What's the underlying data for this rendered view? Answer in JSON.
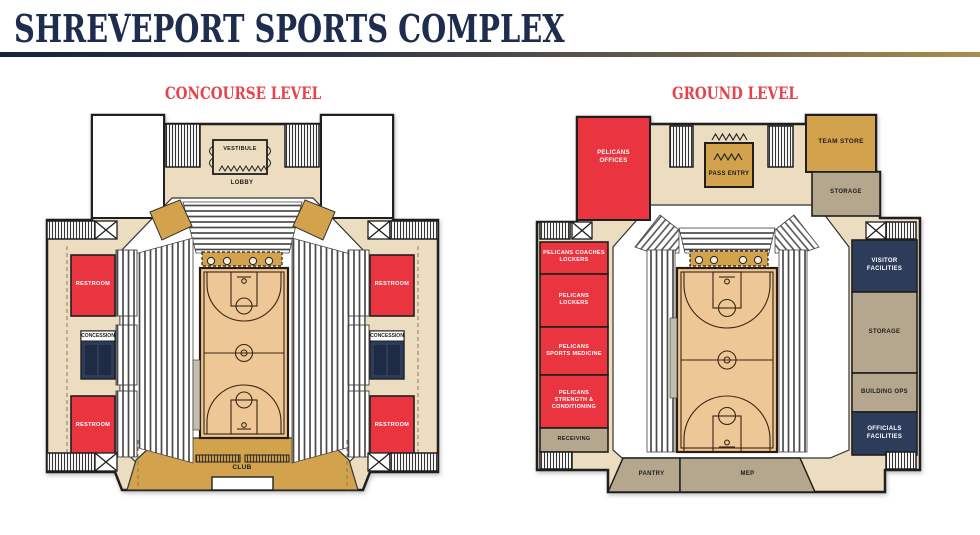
{
  "title": "SHREVEPORT SPORTS COMPLEX",
  "colors": {
    "title_navy": "#1e2c4e",
    "heading_red": "#e8434b",
    "room_red": "#ea3540",
    "room_navy": "#2e3c5c",
    "room_navy_panel": "#1f2b45",
    "room_gold": "#d3a24c",
    "room_tan": "#b5a78d",
    "concourse_beige": "#ecdcc0",
    "court_tan": "#edc795",
    "outline": "#1f1f1f"
  },
  "levels": {
    "concourse": {
      "heading": "CONCOURSE LEVEL",
      "rooms": {
        "vestibule": "VESTIBULE",
        "lobby": "LOBBY",
        "restroom": "RESTROOM",
        "concession": "CONCESSION",
        "club": "CLUB"
      }
    },
    "ground": {
      "heading": "GROUND LEVEL",
      "rooms": {
        "pelicans_offices": "PELICANS\nOFFICES",
        "pass_entry": "PASS ENTRY",
        "team_store": "TEAM STORE",
        "storage_upper": "STORAGE",
        "pelicans_coaches_lockers": "PELICANS COACHES\nLOCKERS",
        "pelicans_lockers": "PELICANS\nLOCKERS",
        "pelicans_sports_medicine": "PELICANS\nSPORTS MEDICINE",
        "pelicans_strength_conditioning": "PELICANS\nSTRENGTH &\nCONDITIONING",
        "receiving": "RECEIVING",
        "visitor_facilities": "VISITOR\nFACILITIES",
        "storage_right": "STORAGE",
        "building_ops": "BUILDING OPS",
        "officials_facilities": "OFFICIALS\nFACILITIES",
        "pantry": "PANTRY",
        "mep": "MEP"
      }
    }
  }
}
